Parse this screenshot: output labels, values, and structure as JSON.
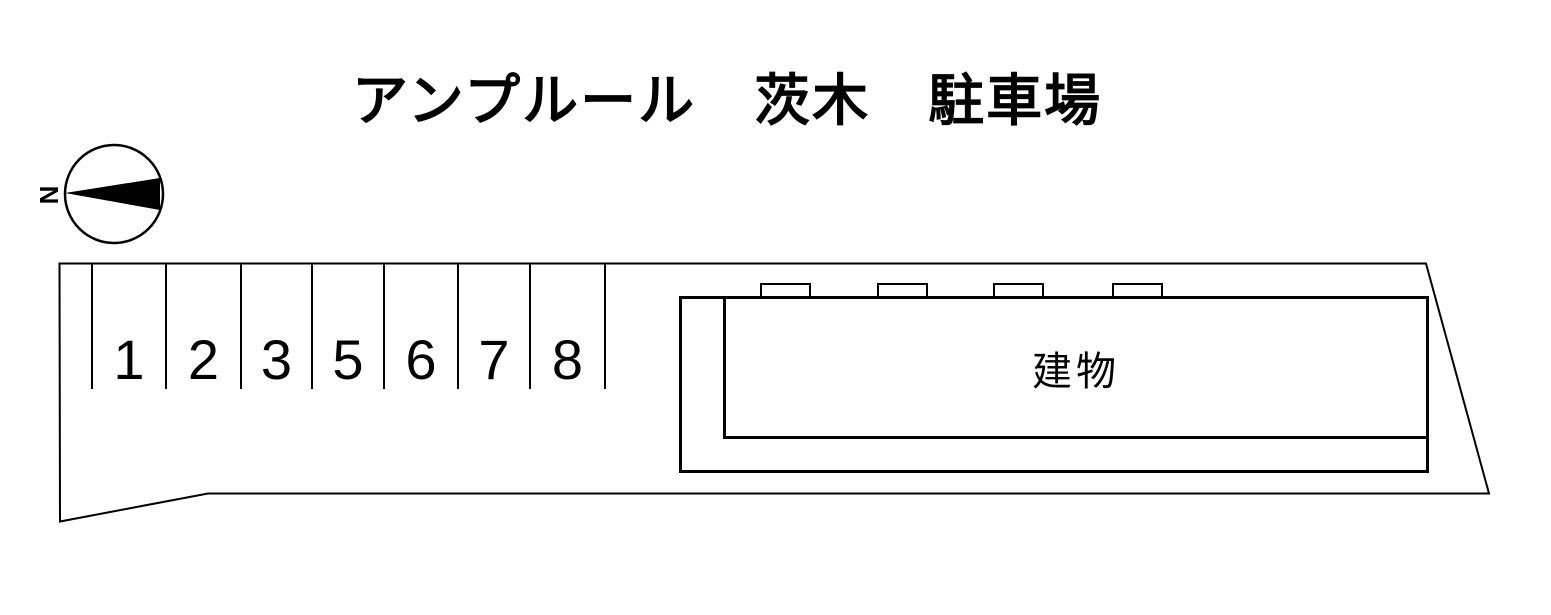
{
  "title": "アンプルール　茨木　駐車場",
  "compass": {
    "north_label": "N",
    "arrow_points": "left"
  },
  "parking": {
    "spots": [
      "1",
      "2",
      "3",
      "5",
      "6",
      "7",
      "8"
    ]
  },
  "building": {
    "label": "建物",
    "entrance_marker_count": 4
  },
  "colors": {
    "line": "#000000",
    "arrow_fill": "#000000",
    "background": "#ffffff"
  }
}
